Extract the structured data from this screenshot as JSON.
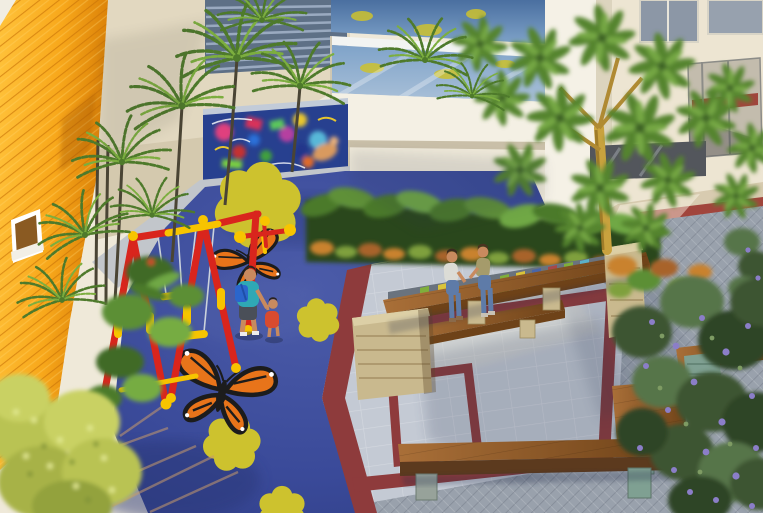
{
  "image_type": "aerial architectural rendering of a condominium courtyard",
  "palette": {
    "building-cream": "#EFE9D9",
    "wall-beige": "#E2D8C0",
    "louver-blue": "#5E7086",
    "louver-slat": "#9AAAC0",
    "glass-blue": "#6E93BE",
    "glass-blue-light": "#9DB8D4",
    "column-white": "#F5F1E6",
    "orange-wall": "#F8A81B",
    "orange-wall-dark": "#D97E06",
    "orange-slat": "#C97307",
    "mural-blue": "#27408F",
    "playground-blue": "#3A4A99",
    "playground-blue-dark": "#2C3878",
    "playground-blue-light": "#5565AC",
    "flower-yellow": "#CDC22E",
    "butterfly-orange": "#E8741A",
    "butterfly-black": "#1C1C1C",
    "swing-red": "#D9251D",
    "swing-yellow": "#F7C400",
    "chain-gray": "#CBD2DC",
    "maroon": "#8E3B3C",
    "plaza-light": "#C4CAD4",
    "herringbone-gray": "#99A1AC",
    "pavement-beige": "#D8CBB0",
    "red-stripe": "#A1453C",
    "wood-brown": "#9A6130",
    "wood-brown-dark": "#6E4218",
    "wood-dark": "#5C3A1E",
    "stone-beige": "#C9B98E",
    "stone-teal": "#7FA092",
    "stripe-green": "#7FAE3C",
    "stripe-yellow": "#D9C33A",
    "stripe-blue": "#4A66A8",
    "palm-green": "#4E7A2B",
    "palm-green-light": "#7CAE3F",
    "hedge-green": "#2C461F",
    "banana-green": "#4C7A2C",
    "croton-orange": "#C9822F",
    "tree-green": "#55842F",
    "tree-green-light": "#76A844",
    "tree-green-dark": "#3E6326",
    "trunk-yellow": "#C9A23E",
    "purple-bloom": "#8B7EC8",
    "purple-tree-green": "#3C5530",
    "bush-yellow-green": "#B9C353",
    "skin": "#C88A5E",
    "teal-shirt": "#2FA8B5",
    "backpack-blue": "#2B66CC",
    "child-red": "#D84B30",
    "denim": "#5E7BA8"
  },
  "scene": {
    "buildings": {
      "rear_facade": "white/cream condo facade with glass balcony railings reflecting the playground, louvered screen panel, white structural column, windows and a red-banded glass rail on the right",
      "left_wall": "orange wood-slat accent wall with one small white-framed window"
    },
    "playground": {
      "surface": "royal-blue rubber safety surface",
      "decals": {
        "yellow_flowers": 4,
        "monarch_butterflies": 2
      },
      "equipment": [
        "red-and-yellow swing set with two seats",
        "red-and-yellow spinner toy"
      ],
      "border": "maroon ribbon separating playground from plaza"
    },
    "plaza": {
      "paving": [
        "light gray paver field with maroon band borders",
        "maroon square inlay",
        "gray herringbone paving",
        "beige concrete walk with red stripe"
      ],
      "furniture": [
        "long angled wood benches with stacked-stone supports",
        "striped tile seat wall (green/yellow/blue)",
        "stone planter cube",
        "low wood platform benches",
        "teal stone cube"
      ]
    },
    "people": [
      {
        "id": "adult-walking",
        "desc": "adult in teal shirt with blue backpack walking on playground"
      },
      {
        "id": "toddler",
        "desc": "small child in red top walking beside adult"
      },
      {
        "id": "seated-woman-1",
        "desc": "woman in light top and jeans seated on wood bench"
      },
      {
        "id": "seated-woman-2",
        "desc": "woman in olive top and jeans seated on wood bench"
      }
    ],
    "vegetation": [
      "palm trees along the orange wall and rear facade",
      "banana/croton hedge planter behind benches",
      "large umbrella-leaf tree with yellow trunk",
      "purple flowering tree lower right",
      "yellow-green shrub lower left"
    ],
    "mural": "colorful graffiti mural wall above the playground"
  }
}
